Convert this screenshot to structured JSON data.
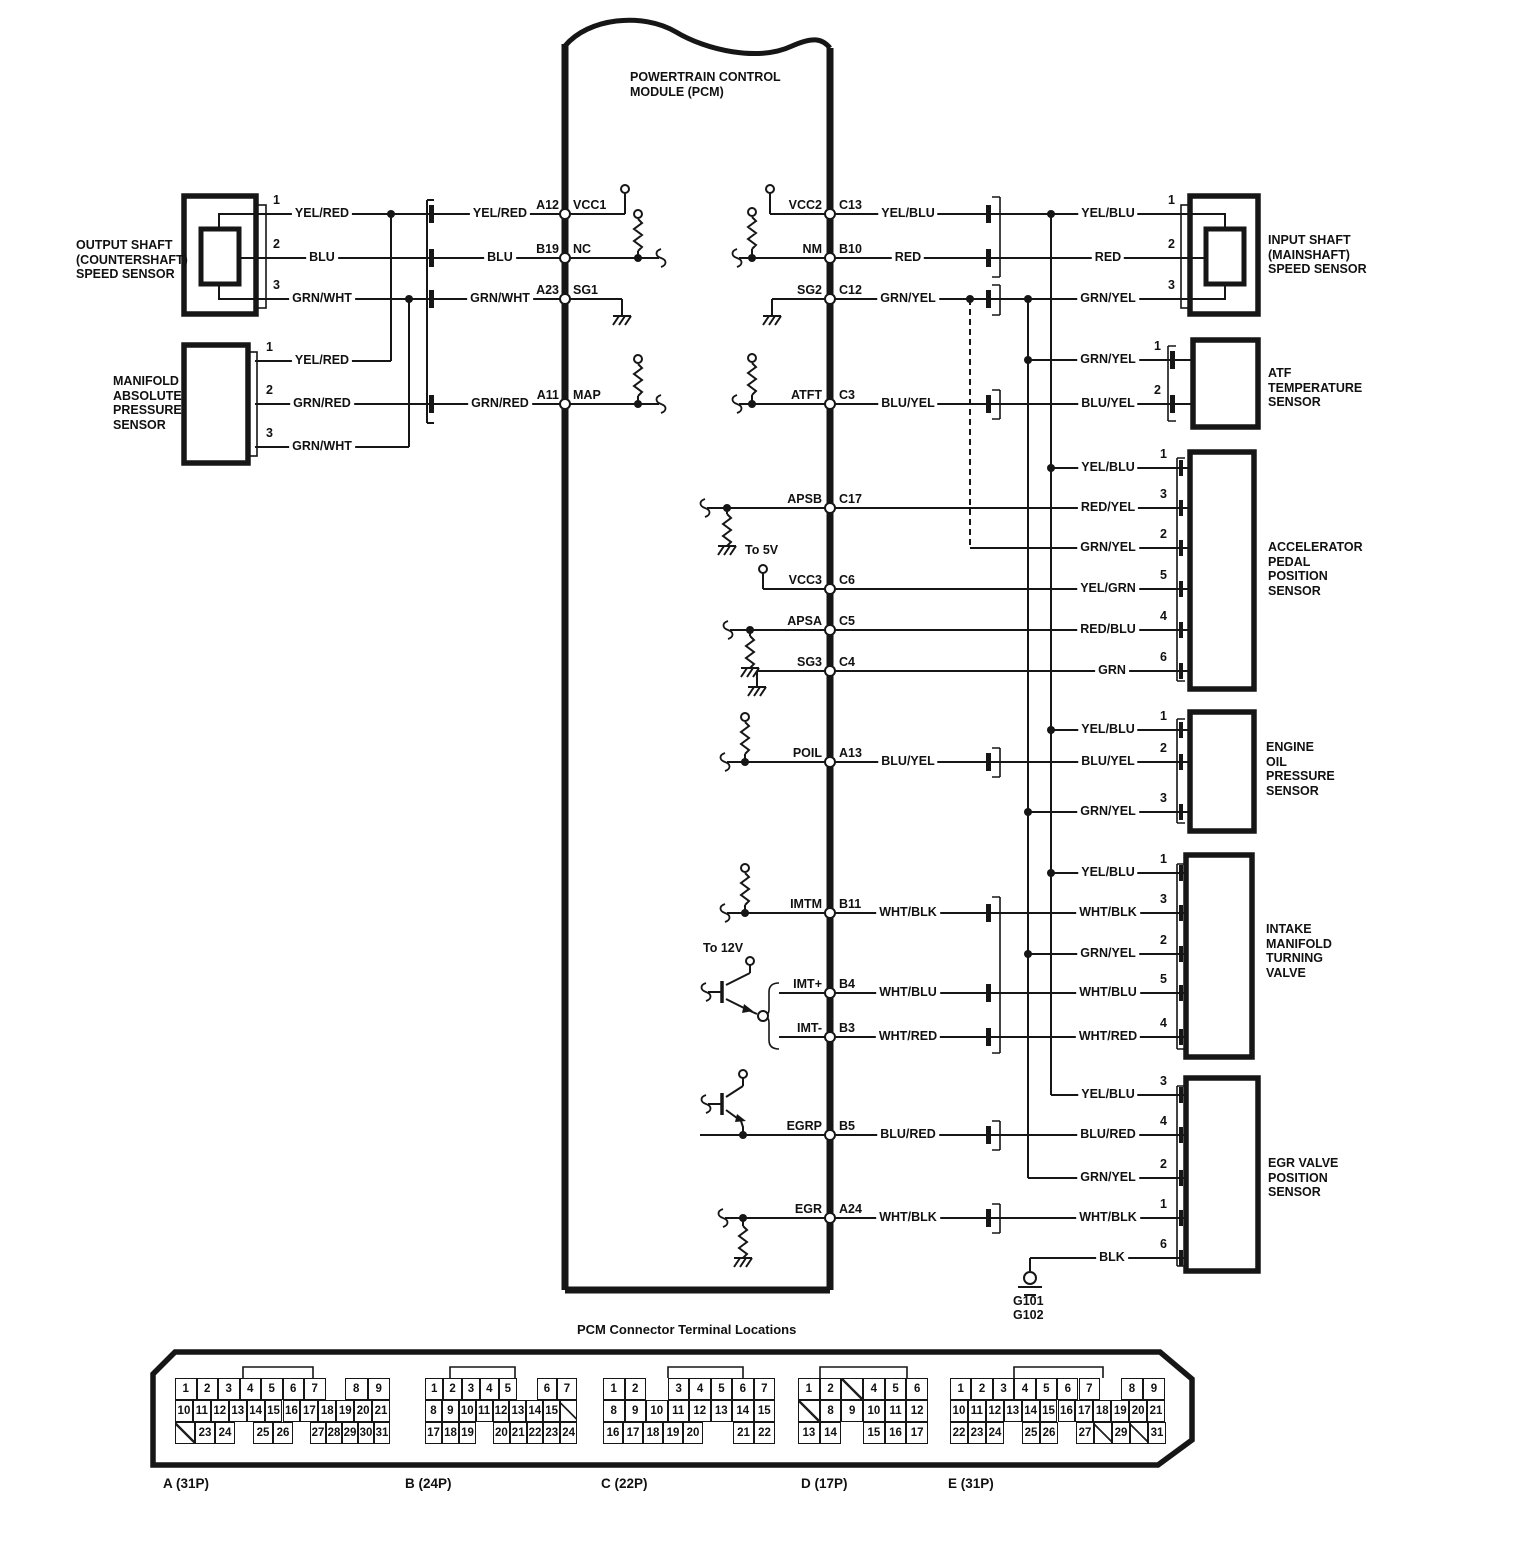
{
  "pcm": {
    "title": "POWERTRAIN CONTROL\nMODULE (PCM)",
    "pins_left": [
      {
        "code": "A12",
        "name": "VCC1",
        "y": 214
      },
      {
        "code": "B19",
        "name": "NC",
        "y": 258
      },
      {
        "code": "A23",
        "name": "SG1",
        "y": 299
      },
      {
        "code": "A11",
        "name": "MAP",
        "y": 404
      }
    ],
    "pins_right": [
      {
        "name": "VCC2",
        "code": "C13",
        "y": 214
      },
      {
        "name": "NM",
        "code": "B10",
        "y": 258
      },
      {
        "name": "SG2",
        "code": "C12",
        "y": 299
      },
      {
        "name": "ATFT",
        "code": "C3",
        "y": 404
      },
      {
        "name": "APSB",
        "code": "C17",
        "y": 508
      },
      {
        "name": "VCC3",
        "code": "C6",
        "y": 589
      },
      {
        "name": "APSA",
        "code": "C5",
        "y": 630
      },
      {
        "name": "SG3",
        "code": "C4",
        "y": 671
      },
      {
        "name": "POIL",
        "code": "A13",
        "y": 762
      },
      {
        "name": "IMTM",
        "code": "B11",
        "y": 913
      },
      {
        "name": "IMT+",
        "code": "B4",
        "y": 993
      },
      {
        "name": "IMT-",
        "code": "B3",
        "y": 1037
      },
      {
        "name": "EGRP",
        "code": "B5",
        "y": 1135
      },
      {
        "name": "EGR",
        "code": "A24",
        "y": 1218
      }
    ]
  },
  "annotations": {
    "to_5v": "To 5V",
    "to_12v": "To 12V",
    "grounds": "G101\nG102"
  },
  "sensor_labels": [
    {
      "t": "OUTPUT SHAFT\n(COUNTERSHAFT)\nSPEED SENSOR",
      "x": 76,
      "y": 238
    },
    {
      "t": "MANIFOLD\nABSOLUTE\nPRESSURE\nSENSOR",
      "x": 113,
      "y": 374
    },
    {
      "t": "INPUT SHAFT\n(MAINSHAFT)\nSPEED SENSOR",
      "x": 1268,
      "y": 233
    },
    {
      "t": "ATF\nTEMPERATURE\nSENSOR",
      "x": 1268,
      "y": 366
    },
    {
      "t": "ACCELERATOR\nPEDAL\nPOSITION\nSENSOR",
      "x": 1268,
      "y": 540
    },
    {
      "t": "ENGINE\nOIL\nPRESSURE\nSENSOR",
      "x": 1266,
      "y": 740
    },
    {
      "t": "INTAKE\nMANIFOLD\nTURNING\nVALVE",
      "x": 1266,
      "y": 922
    },
    {
      "t": "EGR VALVE\nPOSITION\nSENSOR",
      "x": 1268,
      "y": 1156
    }
  ],
  "wire_labels": [
    {
      "t": "YEL/RED",
      "x": 322,
      "y": 214
    },
    {
      "t": "BLU",
      "x": 322,
      "y": 258
    },
    {
      "t": "GRN/WHT",
      "x": 322,
      "y": 299
    },
    {
      "t": "YEL/RED",
      "x": 322,
      "y": 361
    },
    {
      "t": "GRN/RED",
      "x": 322,
      "y": 404
    },
    {
      "t": "GRN/WHT",
      "x": 322,
      "y": 447
    },
    {
      "t": "YEL/RED",
      "x": 500,
      "y": 214
    },
    {
      "t": "BLU",
      "x": 500,
      "y": 258
    },
    {
      "t": "GRN/WHT",
      "x": 500,
      "y": 299
    },
    {
      "t": "GRN/RED",
      "x": 500,
      "y": 404
    },
    {
      "t": "YEL/BLU",
      "x": 908,
      "y": 214
    },
    {
      "t": "RED",
      "x": 908,
      "y": 258
    },
    {
      "t": "GRN/YEL",
      "x": 908,
      "y": 299
    },
    {
      "t": "BLU/YEL",
      "x": 908,
      "y": 404
    },
    {
      "t": "BLU/YEL",
      "x": 908,
      "y": 762
    },
    {
      "t": "WHT/BLK",
      "x": 908,
      "y": 913
    },
    {
      "t": "WHT/BLU",
      "x": 908,
      "y": 993
    },
    {
      "t": "WHT/RED",
      "x": 908,
      "y": 1037
    },
    {
      "t": "BLU/RED",
      "x": 908,
      "y": 1135
    },
    {
      "t": "WHT/BLK",
      "x": 908,
      "y": 1218
    },
    {
      "t": "YEL/BLU",
      "x": 1108,
      "y": 214
    },
    {
      "t": "RED",
      "x": 1108,
      "y": 258
    },
    {
      "t": "GRN/YEL",
      "x": 1108,
      "y": 299
    },
    {
      "t": "GRN/YEL",
      "x": 1108,
      "y": 360
    },
    {
      "t": "BLU/YEL",
      "x": 1108,
      "y": 404
    },
    {
      "t": "YEL/BLU",
      "x": 1108,
      "y": 468
    },
    {
      "t": "RED/YEL",
      "x": 1108,
      "y": 508
    },
    {
      "t": "GRN/YEL",
      "x": 1108,
      "y": 548
    },
    {
      "t": "YEL/GRN",
      "x": 1108,
      "y": 589
    },
    {
      "t": "RED/BLU",
      "x": 1108,
      "y": 630
    },
    {
      "t": "GRN",
      "x": 1112,
      "y": 671
    },
    {
      "t": "YEL/BLU",
      "x": 1108,
      "y": 730
    },
    {
      "t": "BLU/YEL",
      "x": 1108,
      "y": 762
    },
    {
      "t": "GRN/YEL",
      "x": 1108,
      "y": 812
    },
    {
      "t": "YEL/BLU",
      "x": 1108,
      "y": 873
    },
    {
      "t": "WHT/BLK",
      "x": 1108,
      "y": 913
    },
    {
      "t": "GRN/YEL",
      "x": 1108,
      "y": 954
    },
    {
      "t": "WHT/BLU",
      "x": 1108,
      "y": 993
    },
    {
      "t": "WHT/RED",
      "x": 1108,
      "y": 1037
    },
    {
      "t": "YEL/BLU",
      "x": 1108,
      "y": 1095
    },
    {
      "t": "BLU/RED",
      "x": 1108,
      "y": 1135
    },
    {
      "t": "GRN/YEL",
      "x": 1108,
      "y": 1178
    },
    {
      "t": "WHT/BLK",
      "x": 1108,
      "y": 1218
    },
    {
      "t": "BLK",
      "x": 1112,
      "y": 1258
    }
  ],
  "pin_numbers": [
    {
      "t": "1",
      "x": 271,
      "y": 214
    },
    {
      "t": "2",
      "x": 271,
      "y": 258
    },
    {
      "t": "3",
      "x": 271,
      "y": 299
    },
    {
      "t": "1",
      "x": 264,
      "y": 361
    },
    {
      "t": "2",
      "x": 264,
      "y": 404
    },
    {
      "t": "3",
      "x": 264,
      "y": 447
    },
    {
      "t": "1",
      "x": 1166,
      "y": 214
    },
    {
      "t": "2",
      "x": 1166,
      "y": 258
    },
    {
      "t": "3",
      "x": 1166,
      "y": 299
    },
    {
      "t": "1",
      "x": 1152,
      "y": 360
    },
    {
      "t": "2",
      "x": 1152,
      "y": 404
    },
    {
      "t": "1",
      "x": 1158,
      "y": 468
    },
    {
      "t": "3",
      "x": 1158,
      "y": 508
    },
    {
      "t": "2",
      "x": 1158,
      "y": 548
    },
    {
      "t": "5",
      "x": 1158,
      "y": 589
    },
    {
      "t": "4",
      "x": 1158,
      "y": 630
    },
    {
      "t": "6",
      "x": 1158,
      "y": 671
    },
    {
      "t": "1",
      "x": 1158,
      "y": 730
    },
    {
      "t": "2",
      "x": 1158,
      "y": 762
    },
    {
      "t": "3",
      "x": 1158,
      "y": 812
    },
    {
      "t": "1",
      "x": 1158,
      "y": 873
    },
    {
      "t": "3",
      "x": 1158,
      "y": 913
    },
    {
      "t": "2",
      "x": 1158,
      "y": 954
    },
    {
      "t": "5",
      "x": 1158,
      "y": 993
    },
    {
      "t": "4",
      "x": 1158,
      "y": 1037
    },
    {
      "t": "3",
      "x": 1158,
      "y": 1095
    },
    {
      "t": "4",
      "x": 1158,
      "y": 1135
    },
    {
      "t": "2",
      "x": 1158,
      "y": 1178
    },
    {
      "t": "1",
      "x": 1158,
      "y": 1218
    },
    {
      "t": "6",
      "x": 1158,
      "y": 1258
    }
  ],
  "panel": {
    "title": "PCM Connector Terminal Locations",
    "captions": [
      {
        "t": "A (31P)",
        "x": 163,
        "y": 1476
      },
      {
        "t": "B (24P)",
        "x": 405,
        "y": 1476
      },
      {
        "t": "C (22P)",
        "x": 601,
        "y": 1476
      },
      {
        "t": "D (17P)",
        "x": 801,
        "y": 1476
      },
      {
        "t": "E (31P)",
        "x": 948,
        "y": 1476
      }
    ],
    "cells": [
      {
        "t": "1",
        "x": 175,
        "y": 1378,
        "w": 21.5
      },
      {
        "t": "2",
        "x": 196.5,
        "y": 1378,
        "w": 21.5
      },
      {
        "t": "3",
        "x": 218,
        "y": 1378,
        "w": 21.5
      },
      {
        "t": "4",
        "x": 239.5,
        "y": 1378,
        "w": 21.5
      },
      {
        "t": "5",
        "x": 261,
        "y": 1378,
        "w": 21.5
      },
      {
        "t": "6",
        "x": 282.5,
        "y": 1378,
        "w": 21.5
      },
      {
        "t": "7",
        "x": 304,
        "y": 1378,
        "w": 21.5
      },
      {
        "t": "8",
        "x": 345,
        "y": 1378,
        "w": 22.5
      },
      {
        "t": "9",
        "x": 367.5,
        "y": 1378,
        "w": 22.5
      },
      {
        "t": "10",
        "x": 175,
        "y": 1400,
        "w": 17.9
      },
      {
        "t": "11",
        "x": 192.9,
        "y": 1400,
        "w": 17.9
      },
      {
        "t": "12",
        "x": 210.8,
        "y": 1400,
        "w": 17.9
      },
      {
        "t": "13",
        "x": 228.8,
        "y": 1400,
        "w": 17.9
      },
      {
        "t": "14",
        "x": 246.7,
        "y": 1400,
        "w": 17.9
      },
      {
        "t": "15",
        "x": 264.6,
        "y": 1400,
        "w": 17.9
      },
      {
        "t": "16",
        "x": 282.5,
        "y": 1400,
        "w": 17.9
      },
      {
        "t": "17",
        "x": 300.4,
        "y": 1400,
        "w": 17.9
      },
      {
        "t": "18",
        "x": 318.3,
        "y": 1400,
        "w": 17.9
      },
      {
        "t": "19",
        "x": 336.3,
        "y": 1400,
        "w": 17.9
      },
      {
        "t": "20",
        "x": 354.2,
        "y": 1400,
        "w": 17.9
      },
      {
        "t": "21",
        "x": 372.1,
        "y": 1400,
        "w": 17.9
      },
      {
        "t": "",
        "cls": "diag",
        "x": 175,
        "y": 1422,
        "w": 20
      },
      {
        "t": "23",
        "x": 195,
        "y": 1422,
        "w": 20
      },
      {
        "t": "24",
        "x": 215,
        "y": 1422,
        "w": 20
      },
      {
        "t": "25",
        "x": 253,
        "y": 1422,
        "w": 20
      },
      {
        "t": "26",
        "x": 273,
        "y": 1422,
        "w": 20
      },
      {
        "t": "27",
        "x": 310,
        "y": 1422,
        "w": 16
      },
      {
        "t": "28",
        "x": 326,
        "y": 1422,
        "w": 16
      },
      {
        "t": "29",
        "x": 342,
        "y": 1422,
        "w": 16
      },
      {
        "t": "30",
        "x": 358,
        "y": 1422,
        "w": 16
      },
      {
        "t": "31",
        "x": 374,
        "y": 1422,
        "w": 16
      },
      {
        "t": "1",
        "x": 425,
        "y": 1378,
        "w": 18.4
      },
      {
        "t": "2",
        "x": 443.4,
        "y": 1378,
        "w": 18.4
      },
      {
        "t": "3",
        "x": 461.8,
        "y": 1378,
        "w": 18.4
      },
      {
        "t": "4",
        "x": 480.2,
        "y": 1378,
        "w": 18.4
      },
      {
        "t": "5",
        "x": 498.6,
        "y": 1378,
        "w": 18.4
      },
      {
        "t": "6",
        "x": 537,
        "y": 1378,
        "w": 20
      },
      {
        "t": "7",
        "x": 557,
        "y": 1378,
        "w": 20
      },
      {
        "t": "8",
        "x": 425,
        "y": 1400,
        "w": 16.9
      },
      {
        "t": "9",
        "x": 441.9,
        "y": 1400,
        "w": 16.9
      },
      {
        "t": "10",
        "x": 458.8,
        "y": 1400,
        "w": 16.9
      },
      {
        "t": "11",
        "x": 475.7,
        "y": 1400,
        "w": 16.9
      },
      {
        "t": "12",
        "x": 492.6,
        "y": 1400,
        "w": 16.9
      },
      {
        "t": "13",
        "x": 509.4,
        "y": 1400,
        "w": 16.9
      },
      {
        "t": "14",
        "x": 526.3,
        "y": 1400,
        "w": 16.9
      },
      {
        "t": "15",
        "x": 543.2,
        "y": 1400,
        "w": 16.9
      },
      {
        "t": "",
        "cls": "diag",
        "x": 560.1,
        "y": 1400,
        "w": 16.9
      },
      {
        "t": "17",
        "x": 425,
        "y": 1422,
        "w": 17
      },
      {
        "t": "18",
        "x": 442,
        "y": 1422,
        "w": 17
      },
      {
        "t": "19",
        "x": 459,
        "y": 1422,
        "w": 17
      },
      {
        "t": "20",
        "x": 493,
        "y": 1422,
        "w": 16.8
      },
      {
        "t": "21",
        "x": 509.8,
        "y": 1422,
        "w": 16.8
      },
      {
        "t": "22",
        "x": 526.6,
        "y": 1422,
        "w": 16.8
      },
      {
        "t": "23",
        "x": 543.4,
        "y": 1422,
        "w": 16.8
      },
      {
        "t": "24",
        "x": 560.2,
        "y": 1422,
        "w": 16.8
      },
      {
        "t": "1",
        "x": 603,
        "y": 1378,
        "w": 21.5
      },
      {
        "t": "2",
        "x": 624.5,
        "y": 1378,
        "w": 21.5
      },
      {
        "t": "3",
        "x": 668,
        "y": 1378,
        "w": 21.4
      },
      {
        "t": "4",
        "x": 689.4,
        "y": 1378,
        "w": 21.4
      },
      {
        "t": "5",
        "x": 710.8,
        "y": 1378,
        "w": 21.4
      },
      {
        "t": "6",
        "x": 732.2,
        "y": 1378,
        "w": 21.4
      },
      {
        "t": "7",
        "x": 753.6,
        "y": 1378,
        "w": 21.4
      },
      {
        "t": "8",
        "x": 603,
        "y": 1400,
        "w": 21.5
      },
      {
        "t": "9",
        "x": 624.5,
        "y": 1400,
        "w": 21.5
      },
      {
        "t": "10",
        "x": 646,
        "y": 1400,
        "w": 21.5
      },
      {
        "t": "11",
        "x": 667.5,
        "y": 1400,
        "w": 21.5
      },
      {
        "t": "12",
        "x": 689,
        "y": 1400,
        "w": 21.5
      },
      {
        "t": "13",
        "x": 710.5,
        "y": 1400,
        "w": 21.5
      },
      {
        "t": "14",
        "x": 732,
        "y": 1400,
        "w": 21.5
      },
      {
        "t": "15",
        "x": 753.5,
        "y": 1400,
        "w": 21.5
      },
      {
        "t": "16",
        "x": 603,
        "y": 1422,
        "w": 20
      },
      {
        "t": "17",
        "x": 623,
        "y": 1422,
        "w": 20
      },
      {
        "t": "18",
        "x": 643,
        "y": 1422,
        "w": 20
      },
      {
        "t": "19",
        "x": 663,
        "y": 1422,
        "w": 20
      },
      {
        "t": "20",
        "x": 683,
        "y": 1422,
        "w": 20
      },
      {
        "t": "21",
        "x": 733,
        "y": 1422,
        "w": 21
      },
      {
        "t": "22",
        "x": 754,
        "y": 1422,
        "w": 21
      },
      {
        "t": "1",
        "x": 798,
        "y": 1378,
        "w": 21.7
      },
      {
        "t": "2",
        "x": 819.7,
        "y": 1378,
        "w": 21.7
      },
      {
        "t": "",
        "cls": "diag",
        "x": 841.3,
        "y": 1378,
        "w": 21.7
      },
      {
        "t": "4",
        "x": 863,
        "y": 1378,
        "w": 21.7
      },
      {
        "t": "5",
        "x": 884.7,
        "y": 1378,
        "w": 21.7
      },
      {
        "t": "6",
        "x": 906.3,
        "y": 1378,
        "w": 21.7
      },
      {
        "t": "",
        "cls": "diag",
        "x": 798,
        "y": 1400,
        "w": 21.7
      },
      {
        "t": "8",
        "x": 819.7,
        "y": 1400,
        "w": 21.7
      },
      {
        "t": "9",
        "x": 841.3,
        "y": 1400,
        "w": 21.7
      },
      {
        "t": "10",
        "x": 863,
        "y": 1400,
        "w": 21.7
      },
      {
        "t": "11",
        "x": 884.7,
        "y": 1400,
        "w": 21.7
      },
      {
        "t": "12",
        "x": 906.3,
        "y": 1400,
        "w": 21.7
      },
      {
        "t": "13",
        "x": 798,
        "y": 1422,
        "w": 21.7
      },
      {
        "t": "14",
        "x": 819.7,
        "y": 1422,
        "w": 21.7
      },
      {
        "t": "15",
        "x": 863,
        "y": 1422,
        "w": 21.7
      },
      {
        "t": "16",
        "x": 884.7,
        "y": 1422,
        "w": 21.7
      },
      {
        "t": "17",
        "x": 906.3,
        "y": 1422,
        "w": 21.7
      },
      {
        "t": "1",
        "x": 950,
        "y": 1378,
        "w": 21.4
      },
      {
        "t": "2",
        "x": 971.4,
        "y": 1378,
        "w": 21.4
      },
      {
        "t": "3",
        "x": 992.9,
        "y": 1378,
        "w": 21.4
      },
      {
        "t": "4",
        "x": 1014.3,
        "y": 1378,
        "w": 21.4
      },
      {
        "t": "5",
        "x": 1035.7,
        "y": 1378,
        "w": 21.4
      },
      {
        "t": "6",
        "x": 1057.1,
        "y": 1378,
        "w": 21.4
      },
      {
        "t": "7",
        "x": 1078.6,
        "y": 1378,
        "w": 21.4
      },
      {
        "t": "8",
        "x": 1121,
        "y": 1378,
        "w": 22
      },
      {
        "t": "9",
        "x": 1143,
        "y": 1378,
        "w": 22
      },
      {
        "t": "10",
        "x": 950,
        "y": 1400,
        "w": 17.9
      },
      {
        "t": "11",
        "x": 967.9,
        "y": 1400,
        "w": 17.9
      },
      {
        "t": "12",
        "x": 985.8,
        "y": 1400,
        "w": 17.9
      },
      {
        "t": "13",
        "x": 1003.8,
        "y": 1400,
        "w": 17.9
      },
      {
        "t": "14",
        "x": 1021.7,
        "y": 1400,
        "w": 17.9
      },
      {
        "t": "15",
        "x": 1039.6,
        "y": 1400,
        "w": 17.9
      },
      {
        "t": "16",
        "x": 1057.5,
        "y": 1400,
        "w": 17.9
      },
      {
        "t": "17",
        "x": 1075.4,
        "y": 1400,
        "w": 17.9
      },
      {
        "t": "18",
        "x": 1093.3,
        "y": 1400,
        "w": 17.9
      },
      {
        "t": "19",
        "x": 1111.3,
        "y": 1400,
        "w": 17.9
      },
      {
        "t": "20",
        "x": 1129.2,
        "y": 1400,
        "w": 17.9
      },
      {
        "t": "21",
        "x": 1147.1,
        "y": 1400,
        "w": 17.9
      },
      {
        "t": "22",
        "x": 950,
        "y": 1422,
        "w": 18
      },
      {
        "t": "23",
        "x": 968,
        "y": 1422,
        "w": 18
      },
      {
        "t": "24",
        "x": 986,
        "y": 1422,
        "w": 18
      },
      {
        "t": "25",
        "x": 1022,
        "y": 1422,
        "w": 18
      },
      {
        "t": "26",
        "x": 1040,
        "y": 1422,
        "w": 18
      },
      {
        "t": "27",
        "x": 1076,
        "y": 1422,
        "w": 18
      },
      {
        "t": "",
        "cls": "diag",
        "x": 1094,
        "y": 1422,
        "w": 18
      },
      {
        "t": "29",
        "x": 1112,
        "y": 1422,
        "w": 18
      },
      {
        "t": "",
        "cls": "diag",
        "x": 1130,
        "y": 1422,
        "w": 18
      },
      {
        "t": "31",
        "x": 1148,
        "y": 1422,
        "w": 18
      }
    ]
  }
}
